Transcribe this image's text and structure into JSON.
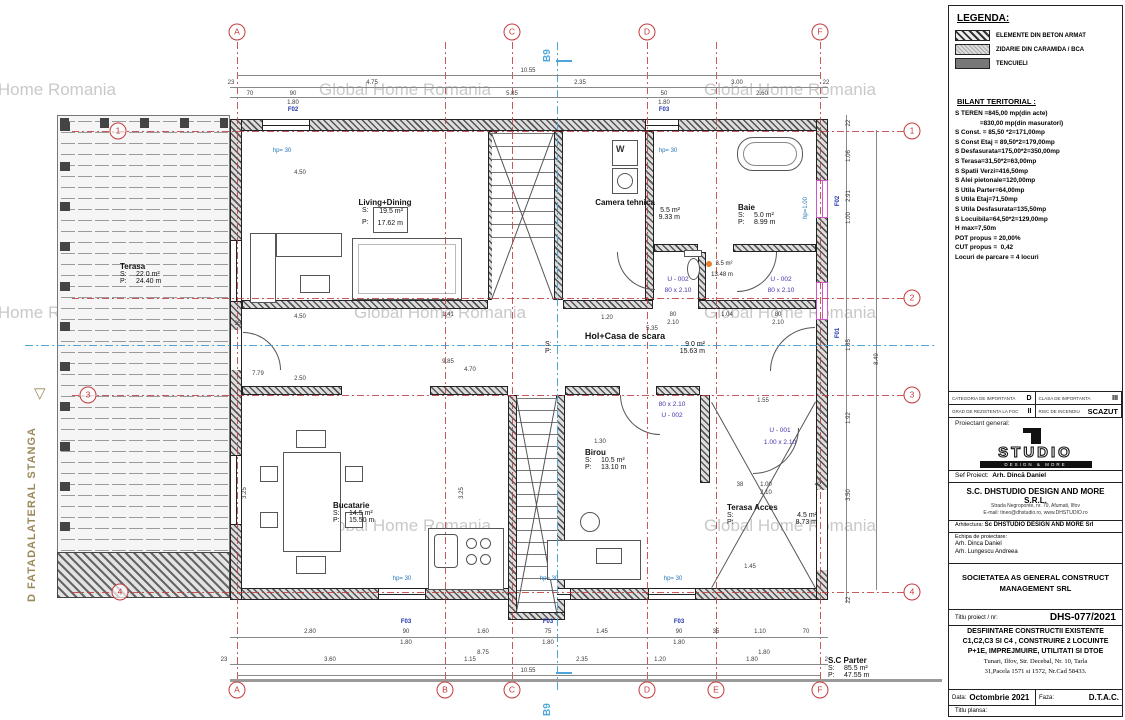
{
  "colors": {
    "axis-red": "#c23b3b",
    "section-blue": "#4da6d9",
    "label-navy": "#2233aa",
    "door-purple": "#4433aa",
    "hp-blue": "#2277bb",
    "facade-tan": "#9a8a5a",
    "win-magenta": "#cc55cc"
  },
  "watermarks": [
    {
      "t": "Global Home Romania",
      "x": 30,
      "y": 80
    },
    {
      "t": "Global Home Romania",
      "x": 405,
      "y": 80
    },
    {
      "t": "Global Home Romania",
      "x": 790,
      "y": 80
    },
    {
      "t": "Global Home Romania",
      "x": 30,
      "y": 303
    },
    {
      "t": "Global Home Romania",
      "x": 440,
      "y": 303
    },
    {
      "t": "Global Home Romania",
      "x": 790,
      "y": 303
    },
    {
      "t": "Global Home Romania",
      "x": 405,
      "y": 516
    },
    {
      "t": "Global Home Romania",
      "x": 790,
      "y": 516
    }
  ],
  "plan": {
    "facade_label": "D FATADALATERAL STANGA",
    "facade_marker": "▽",
    "section_label": "B9",
    "appliances": {
      "washer": "W"
    },
    "labels": {
      "s": "S:",
      "p": "P:"
    },
    "rooms": {
      "living": {
        "name": "Living+Dining",
        "s": "19.5 m²",
        "p": "17.62 m"
      },
      "camera_tehnica": {
        "name": "Camera tehnica",
        "s": "5.5 m²",
        "p": "9.33 m"
      },
      "baie": {
        "name": "Baie",
        "s": "5.0 m²",
        "p": "8.99 m"
      },
      "wc": {
        "s": "3.5 m²",
        "p": "13.48 m"
      },
      "hol": {
        "name": "Hol+Casa de scara",
        "s": "9.0 m²",
        "p": "15.63 m"
      },
      "bucatarie": {
        "name": "Bucatarie",
        "s": "14.5 m²",
        "p": "15.50 m"
      },
      "birou": {
        "name": "Birou",
        "s": "10.5 m²",
        "p": "13.10 m"
      },
      "terasa_acces": {
        "name": "Terasa Acces",
        "s": "4.5 m²",
        "p": "8.73 m"
      },
      "terasa": {
        "name": "Terasa",
        "s": "22.0 m²",
        "p": "24.40 m"
      },
      "parter": {
        "name": "S.C Parter",
        "s": "85.5 m²",
        "p": "47.55 m"
      }
    },
    "axis_bubbles": [
      {
        "t": "A",
        "x": 237,
        "y": 32
      },
      {
        "t": "C",
        "x": 512,
        "y": 32
      },
      {
        "t": "D",
        "x": 647,
        "y": 32
      },
      {
        "t": "F",
        "x": 820,
        "y": 32
      },
      {
        "t": "A",
        "x": 237,
        "y": 690
      },
      {
        "t": "B",
        "x": 445,
        "y": 690
      },
      {
        "t": "C",
        "x": 512,
        "y": 690
      },
      {
        "t": "D",
        "x": 647,
        "y": 690
      },
      {
        "t": "E",
        "x": 716,
        "y": 690
      },
      {
        "t": "F",
        "x": 820,
        "y": 690
      },
      {
        "t": "1",
        "x": 912,
        "y": 131
      },
      {
        "t": "2",
        "x": 912,
        "y": 298
      },
      {
        "t": "3",
        "x": 912,
        "y": 395
      },
      {
        "t": "4",
        "x": 912,
        "y": 592
      },
      {
        "t": "1",
        "x": 118,
        "y": 131
      },
      {
        "t": "3",
        "x": 88,
        "y": 395
      },
      {
        "t": "4",
        "x": 120,
        "y": 592
      }
    ],
    "annotations": [
      {
        "t": "10.55",
        "x": 528,
        "y": 68
      },
      {
        "t": "23",
        "x": 231,
        "y": 80
      },
      {
        "t": "4.75",
        "x": 372,
        "y": 80
      },
      {
        "t": "2.35",
        "x": 580,
        "y": 80
      },
      {
        "t": "3.00",
        "x": 737,
        "y": 80
      },
      {
        "t": "22",
        "x": 826,
        "y": 80
      },
      {
        "t": "70",
        "x": 250,
        "y": 91
      },
      {
        "t": "90",
        "x": 293,
        "y": 91
      },
      {
        "t": "5.85",
        "x": 512,
        "y": 91
      },
      {
        "t": "50",
        "x": 664,
        "y": 91
      },
      {
        "t": "2.60",
        "x": 762,
        "y": 91
      },
      {
        "t": "1.80",
        "x": 293,
        "y": 100
      },
      {
        "t": "1.80",
        "x": 664,
        "y": 100
      },
      {
        "t": "F02",
        "x": 293,
        "y": 107,
        "c": "fl"
      },
      {
        "t": "F03",
        "x": 664,
        "y": 107,
        "c": "fl"
      },
      {
        "t": "hp= 30",
        "x": 282,
        "y": 148,
        "c": "hp"
      },
      {
        "t": "hp= 30",
        "x": 668,
        "y": 148,
        "c": "hp"
      },
      {
        "t": "hp=1.00",
        "x": 806,
        "y": 205,
        "r": -90,
        "c": "hp"
      },
      {
        "t": "F02",
        "x": 838,
        "y": 198,
        "r": -90,
        "c": "fl"
      },
      {
        "t": "F01",
        "x": 838,
        "y": 330,
        "r": -90,
        "c": "fl"
      },
      {
        "t": "4.50",
        "x": 300,
        "y": 170
      },
      {
        "t": "4.50",
        "x": 300,
        "y": 314
      },
      {
        "t": "35",
        "x": 238,
        "y": 321
      },
      {
        "t": "1.41",
        "x": 448,
        "y": 312
      },
      {
        "t": "1.20",
        "x": 607,
        "y": 315
      },
      {
        "t": "80",
        "x": 673,
        "y": 312
      },
      {
        "t": "2.10",
        "x": 673,
        "y": 320
      },
      {
        "t": "1.04",
        "x": 727,
        "y": 312
      },
      {
        "t": "80",
        "x": 778,
        "y": 312
      },
      {
        "t": "2.10",
        "x": 778,
        "y": 320
      },
      {
        "t": "5.35",
        "x": 652,
        "y": 326
      },
      {
        "t": "9.85",
        "x": 448,
        "y": 359
      },
      {
        "t": "4.70",
        "x": 470,
        "y": 367
      },
      {
        "t": "7.79",
        "x": 258,
        "y": 371
      },
      {
        "t": "2.50",
        "x": 300,
        "y": 376
      },
      {
        "t": "3.25",
        "x": 245,
        "y": 490,
        "r": -90
      },
      {
        "t": "3.25",
        "x": 462,
        "y": 490,
        "r": -90
      },
      {
        "t": "1.30",
        "x": 600,
        "y": 439
      },
      {
        "t": "1.55",
        "x": 763,
        "y": 398
      },
      {
        "t": "38",
        "x": 740,
        "y": 482
      },
      {
        "t": "1.00",
        "x": 766,
        "y": 482
      },
      {
        "t": "2.10",
        "x": 766,
        "y": 490
      },
      {
        "t": "42",
        "x": 818,
        "y": 482
      },
      {
        "t": "1.45",
        "x": 750,
        "y": 564
      },
      {
        "t": "U - 002",
        "x": 678,
        "y": 276,
        "c": "dr"
      },
      {
        "t": "80 x 2.10",
        "x": 678,
        "y": 287,
        "c": "dr"
      },
      {
        "t": "U - 002",
        "x": 781,
        "y": 276,
        "c": "dr"
      },
      {
        "t": "80 x 2.10",
        "x": 781,
        "y": 287,
        "c": "dr"
      },
      {
        "t": "80 x 2.10",
        "x": 672,
        "y": 401,
        "c": "dr"
      },
      {
        "t": "U - 002",
        "x": 672,
        "y": 412,
        "c": "dr"
      },
      {
        "t": "U - 001",
        "x": 780,
        "y": 427,
        "c": "dr"
      },
      {
        "t": "1.00 x 2.10",
        "x": 780,
        "y": 439,
        "c": "dr"
      },
      {
        "t": "3.5 m²",
        "x": 724,
        "y": 261,
        "c": "sm"
      },
      {
        "t": "13.48 m",
        "x": 722,
        "y": 272,
        "c": "sm"
      },
      {
        "t": "hp= 30",
        "x": 402,
        "y": 576,
        "c": "hp"
      },
      {
        "t": "hp= 30",
        "x": 549,
        "y": 576,
        "c": "hp"
      },
      {
        "t": "hp= 30",
        "x": 673,
        "y": 576,
        "c": "hp"
      },
      {
        "t": "F03",
        "x": 406,
        "y": 619,
        "c": "fl"
      },
      {
        "t": "F03",
        "x": 548,
        "y": 619,
        "c": "fl"
      },
      {
        "t": "F03",
        "x": 679,
        "y": 619,
        "c": "fl"
      },
      {
        "t": "2.80",
        "x": 310,
        "y": 629
      },
      {
        "t": "90",
        "x": 406,
        "y": 629
      },
      {
        "t": "1.60",
        "x": 483,
        "y": 629
      },
      {
        "t": "75",
        "x": 548,
        "y": 629
      },
      {
        "t": "1.45",
        "x": 602,
        "y": 629
      },
      {
        "t": "90",
        "x": 679,
        "y": 629
      },
      {
        "t": "35",
        "x": 716,
        "y": 629
      },
      {
        "t": "1.10",
        "x": 760,
        "y": 629
      },
      {
        "t": "70",
        "x": 806,
        "y": 629
      },
      {
        "t": "1.80",
        "x": 406,
        "y": 640
      },
      {
        "t": "1.80",
        "x": 548,
        "y": 640
      },
      {
        "t": "1.80",
        "x": 679,
        "y": 640
      },
      {
        "t": "8.75",
        "x": 483,
        "y": 650
      },
      {
        "t": "1.80",
        "x": 764,
        "y": 650
      },
      {
        "t": "23",
        "x": 224,
        "y": 657
      },
      {
        "t": "3.60",
        "x": 330,
        "y": 657
      },
      {
        "t": "1.15",
        "x": 470,
        "y": 657
      },
      {
        "t": "2.35",
        "x": 582,
        "y": 657
      },
      {
        "t": "1.20",
        "x": 660,
        "y": 657
      },
      {
        "t": "1.80",
        "x": 752,
        "y": 657
      },
      {
        "t": "22",
        "x": 828,
        "y": 657
      },
      {
        "t": "10.55",
        "x": 528,
        "y": 668
      },
      {
        "t": "22",
        "x": 849,
        "y": 120,
        "r": -90
      },
      {
        "t": "1.06",
        "x": 849,
        "y": 153,
        "r": -90
      },
      {
        "t": "2.91",
        "x": 849,
        "y": 193,
        "r": -90
      },
      {
        "t": "1.00",
        "x": 849,
        "y": 215,
        "r": -90
      },
      {
        "t": "1.85",
        "x": 849,
        "y": 342,
        "r": -90
      },
      {
        "t": "1.92",
        "x": 849,
        "y": 415,
        "r": -90
      },
      {
        "t": "3.50",
        "x": 849,
        "y": 492,
        "r": -90
      },
      {
        "t": "22",
        "x": 849,
        "y": 597,
        "r": -90
      },
      {
        "t": "8.49",
        "x": 877,
        "y": 356,
        "r": -90
      }
    ]
  },
  "legend": {
    "title": "LEGENDA:",
    "items": [
      {
        "label": "ELEMENTE DIN BETON ARMAT"
      },
      {
        "label": "ZIDARIE DIN CARAMIDA / BCA"
      },
      {
        "label": "TENCUIELI"
      }
    ]
  },
  "bilant": {
    "title": "BILANT TERITORIAL :",
    "lines": [
      {
        "t": "S TEREN =845,00 mp(din acte)"
      },
      {
        "t": "              =830,00 mp(din masuratori)"
      },
      {
        "t": "S Const. = 85,50 *2=171,00mp"
      },
      {
        "t": "S Const Etaj = 89,50*2=179,00mp"
      },
      {
        "t": "S Desfasurata=175,00*2=350,00mp"
      },
      {
        "t": "S Terasa=31,50*2=63,00mp"
      },
      {
        "t": "S Spatii Verzi=416,50mp"
      },
      {
        "t": "S Alei pietonale=120,00mp"
      },
      {
        "t": "S Utila Parter=64,00mp"
      },
      {
        "t": "S Utila Etaj=71,50mp"
      },
      {
        "t": "S Utila Desfasurata=135,50mp"
      },
      {
        "t": "S Locuibila=64,50*2=129,00mp"
      },
      {
        "t": "H max=7,50m"
      },
      {
        "t": "POT propus = 20,00%"
      },
      {
        "t": "CUT propus =  0,42"
      },
      {
        "t": "Locuri de parcare = 4 locuri"
      }
    ]
  },
  "panel": {
    "importance": {
      "c1_label": "CATEGORIA DE IMPORTANTA",
      "c1_value": "D",
      "c2_label": "CLASA DE IMPORTANTA",
      "c2_value": "III",
      "c3_label": "GRAD DE REZISTENTA LA FOC",
      "c3_value": "II",
      "c4_label": "RISC DE INCENDIU",
      "c4_value": "SCAZUT"
    },
    "proiectant_label": "Proiectant general:",
    "logo_word": "STUDIO",
    "logo_band": "DESIGN & MORE",
    "sef_label": "Sef Proiect:",
    "sef_value": "Arh. Dincă Daniel",
    "firm": "S.C. DHSTUDIO DESIGN AND MORE S.R.L.",
    "addr1": "Strada Negroponte, nr. 79, Afumati, Ilfov",
    "addr2": "E-mail: tineo@dhstudio.ro, www.DHSTUDIO.ro",
    "arhitectura_label": "Arhitectura:",
    "arhitectura_value": "Sc DHSTUDIO DESIGN AND MORE Srl",
    "echipa_label": "Echipa de proiectare:",
    "echipa": [
      {
        "t": "Arh. Dinca Daniel"
      },
      {
        "t": "Arh. Lungescu Andreea"
      }
    ],
    "beneficiar": "SOCIETATEA AS GENERAL CONSTRUCT MANAGEMENT SRL",
    "titlu_proiect_label": "Titlu proiect / nr:",
    "proiect_nr": "DHS-077/2021",
    "desc_bold": [
      {
        "t": "DESFIINTARE CONSTRUCTII EXISTENTE"
      },
      {
        "t": "C1,C2,C3 SI C4 , CONSTRUIRE 2 LOCUINTE"
      },
      {
        "t": "P+1E, IMPREJMUIRE, UTILITATI SI DTOE"
      }
    ],
    "desc_serif": [
      {
        "t": "Tunari, Ilfov,  Str. Decebal, Nr. 10, Tarla"
      },
      {
        "t": "31,Pacela 1571 si 1572, Nr.Cad 58433."
      }
    ],
    "data_label": "Data:",
    "data_value": "Octombrie 2021",
    "faza_label": "Faza:",
    "faza_value": "D.T.A.C.",
    "plansa_label": "Titlu plansa:"
  }
}
